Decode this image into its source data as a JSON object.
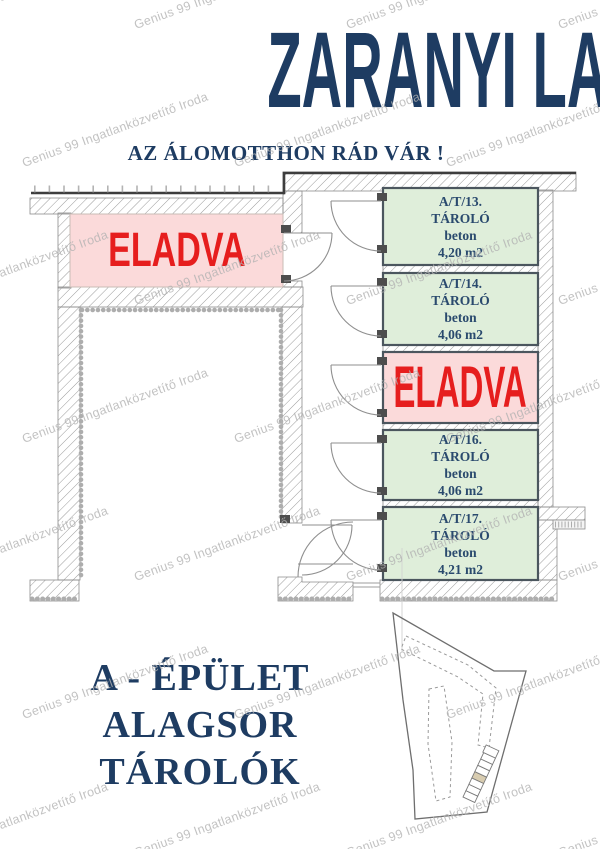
{
  "header": {
    "title": "ZARANYI LAKÓPARK",
    "subtitle": "AZ ÁLOMOTTHON RÁD VÁR !"
  },
  "watermark": {
    "text": "Genius 99 Ingatlanközvetítő Iroda"
  },
  "floorplan": {
    "left_room": {
      "label": "ELADVA",
      "status": "sold"
    },
    "units": [
      {
        "id": "A/T/13.",
        "type": "TÁROLÓ",
        "material": "beton",
        "area": "4,20 m2",
        "status": "available"
      },
      {
        "id": "A/T/14.",
        "type": "TÁROLÓ",
        "material": "beton",
        "area": "4,06 m2",
        "status": "available"
      },
      {
        "label": "ELADVA",
        "status": "sold"
      },
      {
        "id": "A/T/16.",
        "type": "TÁROLÓ",
        "material": "beton",
        "area": "4,06 m2",
        "status": "available"
      },
      {
        "id": "A/T/17.",
        "type": "TÁROLÓ",
        "material": "beton",
        "area": "4,21 m2",
        "status": "available"
      }
    ]
  },
  "footer": {
    "line1": "A - ÉPÜLET",
    "line2": "ALAGSOR",
    "line3": "TÁROLÓK"
  },
  "colors": {
    "navy": "#1e3c62",
    "red": "#e61e1e",
    "sold_bg": "#fbdada",
    "unit_bg": "#dfeeda",
    "watermark": "#b3b3b3"
  }
}
